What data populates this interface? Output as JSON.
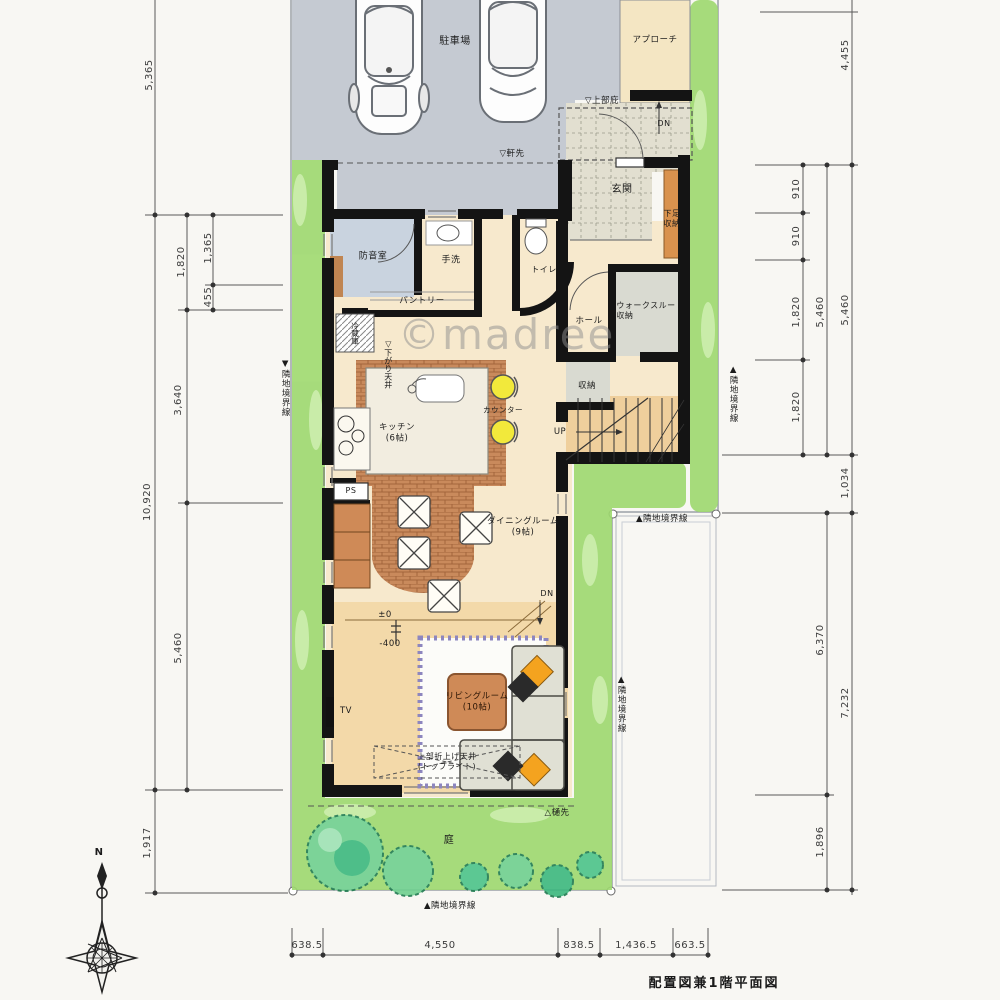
{
  "meta": {
    "drawing_title": "配置図兼1階平面図",
    "watermark": "©madree",
    "compass_north": "N"
  },
  "palette": {
    "wall": "#141414",
    "parking": "#c5cad2",
    "floor": "#f7e9cd",
    "floor_step": "#f3d9a9",
    "tile": "#e2dfd0",
    "green": "#9ed96f",
    "tree": "#56c98b",
    "wood": "#cf8a57",
    "brick": "#c0784c",
    "soundproof": "#c9d3df",
    "storage": "#d9dad1",
    "stool": "#f2e93b",
    "cushion_orange": "#f4a31f",
    "rug_border": "#8d86bf",
    "approach": "#f4e6c3"
  },
  "labels": {
    "parking": "駐車場",
    "approach": "アプローチ",
    "canopy": "▽上部庇",
    "dn_porch": "DN",
    "eaves": "▽軒先",
    "entrance": "玄関",
    "shoe_line1": "下足",
    "shoe_line2": "収納",
    "soundproof": "防音室",
    "washbasin": "手洗",
    "toilet": "トイレ",
    "pantry": "パントリー",
    "fridge": "冷蔵庫",
    "dropped_ceiling": "▽下がり天井",
    "hall": "ホール",
    "wtc_line1": "ウォークスルー",
    "wtc_line2": "収納",
    "storage": "収納",
    "up": "UP",
    "kitchen_name": "キッチン",
    "kitchen_size": "(6帖)",
    "counter": "カウンター",
    "dining_name": "ダイニングルーム",
    "dining_size": "(9帖)",
    "level_zero": "±0",
    "level_minus": "-400",
    "dn_living": "DN",
    "tv": "TV",
    "ps": "PS",
    "living_name": "リビングルーム",
    "living_size": "(10帖)",
    "ceiling_line1": "上部折上げ天井",
    "ceiling_line2": "(トップライト)",
    "gutter": "△樋先",
    "garden": "庭",
    "boundary_left": "▼隣地境界線",
    "boundary_right_upper": "▲隣地境界線",
    "boundary_mid": "▲隣地境界線",
    "boundary_right_lower": "▲隣地境界線",
    "boundary_bottom": "▲隣地境界線"
  },
  "dims": {
    "left_outer": [
      "5,365",
      "10,920",
      "1,917"
    ],
    "left_inner": [
      "1,820",
      "3,640",
      "5,460"
    ],
    "left_sub": [
      "1,365",
      "455"
    ],
    "right_inner": [
      "910",
      "910",
      "1,820",
      "1,820"
    ],
    "right_mid": [
      "5,460",
      "6,370",
      "1,896"
    ],
    "right_outer": [
      "4,455",
      "5,460",
      "1,034",
      "7,232"
    ],
    "bottom": [
      "638.5",
      "4,550",
      "838.5",
      "1,436.5",
      "663.5"
    ]
  }
}
